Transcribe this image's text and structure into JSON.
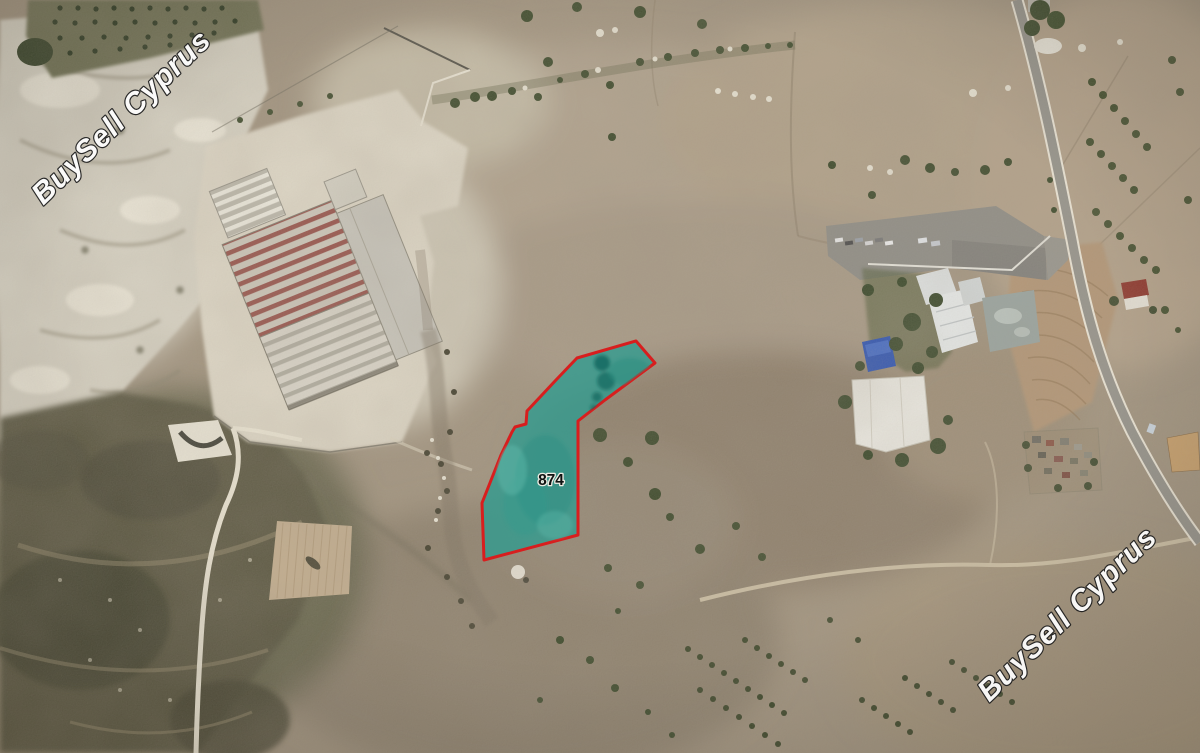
{
  "map": {
    "parcel": {
      "label": "874",
      "label_color": "#0e0e0e",
      "points": "636,341 655,363 605,400 578,421 578,535 484,560 482,503 501,455 512,432 515,427 526,424 527,411 556,380 577,358",
      "fill": "#2E9B8F",
      "fill_opacity": "0.78",
      "stroke": "#D81E1E",
      "stroke_width": "3"
    },
    "watermark": {
      "text": "BuySell Cyprus",
      "color": "#ffffff",
      "outline": "#1e1e1e",
      "instances": [
        {
          "position": "top-left",
          "transform": "translate(128 124) rotate(-44)"
        },
        {
          "position": "bottom-right",
          "transform": "translate(1074 621) rotate(-44)"
        }
      ]
    }
  }
}
